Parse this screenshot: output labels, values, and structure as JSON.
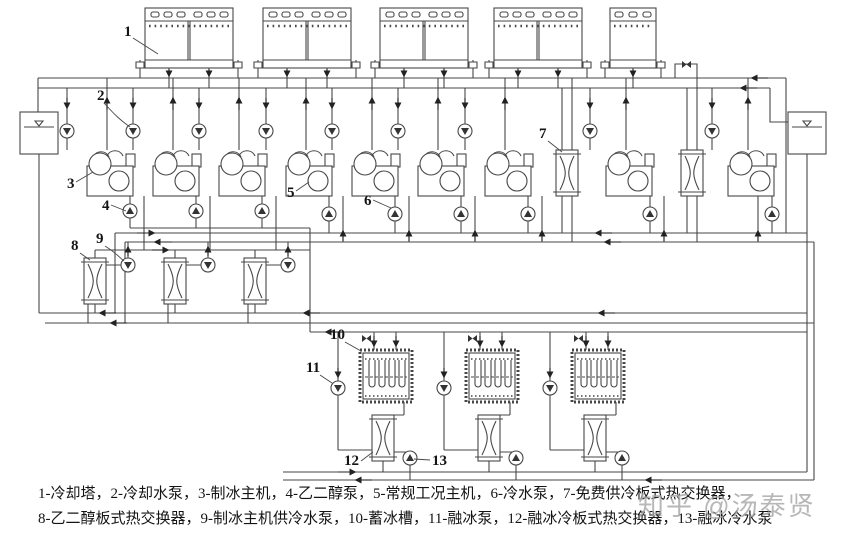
{
  "colors": {
    "background": "#ffffff",
    "line": "#474747",
    "text": "#141414",
    "watermark": "#a6a6a6"
  },
  "callouts": {
    "c1": "1",
    "c2": "2",
    "c3": "3",
    "c4": "4",
    "c5": "5",
    "c6": "6",
    "c7": "7",
    "c8": "8",
    "c9": "9",
    "c10": "10",
    "c11": "11",
    "c12": "12",
    "c13": "13"
  },
  "legend": {
    "line1": "1-冷却塔，2-冷却水泵，3-制冰主机，4-乙二醇泵，5-常规工况主机，6-冷水泵，7-免费供冷板式热交换器，",
    "line2": "8-乙二醇板式热交换器，9-制冰主机供冷水泵，10-蓄冰槽，11-融冰泵，12-融冰冷板式热交换器，13-融冰冷水泵",
    "items": [
      {
        "num": "1",
        "name": "冷却塔"
      },
      {
        "num": "2",
        "name": "冷却水泵"
      },
      {
        "num": "3",
        "name": "制冰主机"
      },
      {
        "num": "4",
        "name": "乙二醇泵"
      },
      {
        "num": "5",
        "name": "常规工况主机"
      },
      {
        "num": "6",
        "name": "冷水泵"
      },
      {
        "num": "7",
        "name": "免费供冷板式热交换器"
      },
      {
        "num": "8",
        "name": "乙二醇板式热交换器"
      },
      {
        "num": "9",
        "name": "制冰主机供冷水泵"
      },
      {
        "num": "10",
        "name": "蓄冰槽"
      },
      {
        "num": "11",
        "name": "融冰泵"
      },
      {
        "num": "12",
        "name": "融冰冷板式热交换器"
      },
      {
        "num": "13",
        "name": "融冰冷水泵"
      }
    ]
  },
  "watermark": {
    "text": "知乎 @汤泰贤"
  }
}
